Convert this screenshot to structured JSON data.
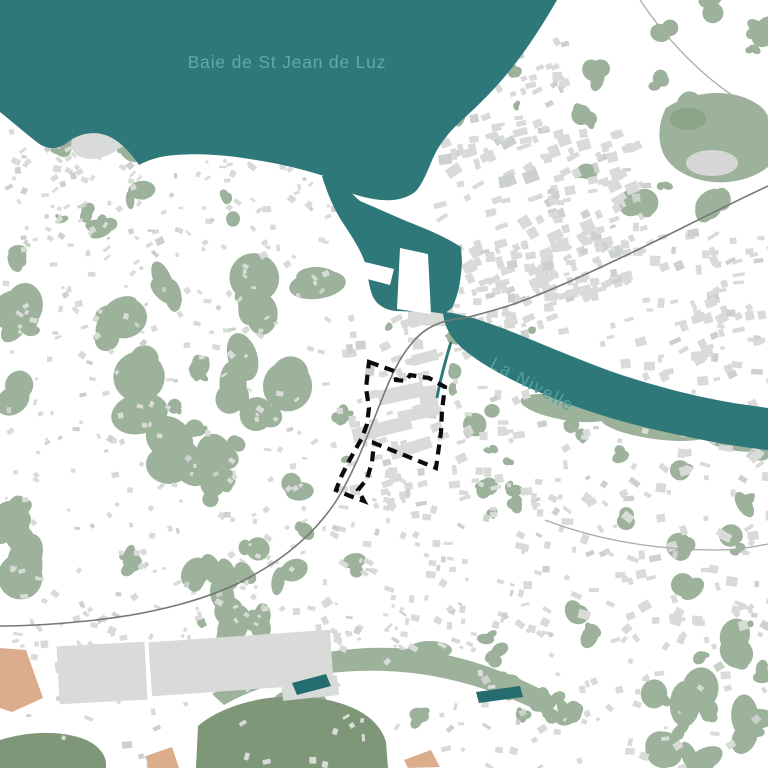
{
  "map": {
    "labels": {
      "bay": {
        "text": "Baie de St Jean de Luz",
        "color": "#64A8A4"
      },
      "river": {
        "text": "La Nivelle",
        "color": "#4FA2A1"
      }
    },
    "colors": {
      "water": "#2E787A",
      "pond": "#256C6F",
      "vegetation": "#9CB29A",
      "vegetation_dark": "#7D9778",
      "building": "#D9DBD8",
      "building_dark": "#CDD1CD",
      "land": "#FFFFFF",
      "road": "#ABABAB",
      "railway": "#777777",
      "sand": "#DCAD8D",
      "boundary": "#0B0B0B"
    },
    "boundary": {
      "points": [
        [
          369,
          362
        ],
        [
          394,
          371
        ],
        [
          396,
          380
        ],
        [
          406,
          381
        ],
        [
          410,
          375
        ],
        [
          429,
          378
        ],
        [
          445,
          387
        ],
        [
          442,
          410
        ],
        [
          441,
          432
        ],
        [
          436,
          468
        ],
        [
          374,
          443
        ],
        [
          372,
          462
        ],
        [
          367,
          479
        ],
        [
          358,
          490
        ],
        [
          364,
          501
        ],
        [
          350,
          496
        ],
        [
          336,
          490
        ],
        [
          341,
          477
        ],
        [
          348,
          463
        ],
        [
          355,
          450
        ],
        [
          362,
          438
        ],
        [
          367,
          424
        ],
        [
          369,
          408
        ],
        [
          366,
          388
        ]
      ]
    },
    "features": {
      "ponds": [
        [
          [
            292,
            683
          ],
          [
            326,
            674
          ],
          [
            331,
            686
          ],
          [
            297,
            695
          ]
        ],
        [
          [
            476,
            692
          ],
          [
            520,
            686
          ],
          [
            523,
            697
          ],
          [
            479,
            703
          ]
        ]
      ],
      "sand_patches": [
        [
          [
            0,
            648
          ],
          [
            26,
            650
          ],
          [
            43,
            698
          ],
          [
            12,
            712
          ],
          [
            0,
            708
          ]
        ],
        [
          [
            146,
            756
          ],
          [
            172,
            747
          ],
          [
            179,
            768
          ],
          [
            148,
            768
          ]
        ],
        [
          [
            404,
            760
          ],
          [
            431,
            750
          ],
          [
            440,
            767
          ],
          [
            408,
            768
          ]
        ]
      ]
    }
  }
}
